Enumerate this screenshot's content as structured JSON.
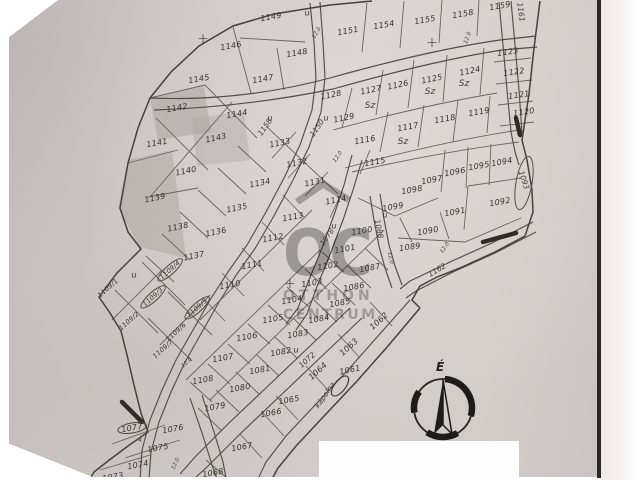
{
  "map": {
    "paper_color": "#d6d0ce",
    "ink_color": "#4c463f",
    "watermark": {
      "letters": "OC",
      "line1": "OTTHON",
      "line2": "CENTRUM"
    },
    "compass": {
      "label": "É"
    },
    "marks": {
      "u_text": "u",
      "sz_text": "Sz",
      "cross_text": "+",
      "sub_mark": "4"
    },
    "parcels": [
      {
        "id": "1149",
        "x": 271,
        "y": 17,
        "r": -10
      },
      {
        "id": "1146",
        "x": 231,
        "y": 46,
        "r": -10
      },
      {
        "id": "1148",
        "x": 297,
        "y": 53,
        "r": -10
      },
      {
        "id": "1151",
        "x": 348,
        "y": 31,
        "r": -10
      },
      {
        "id": "1154",
        "x": 384,
        "y": 25,
        "r": -10
      },
      {
        "id": "1155",
        "x": 425,
        "y": 20,
        "r": -10
      },
      {
        "id": "1158",
        "x": 463,
        "y": 14,
        "r": -10
      },
      {
        "id": "1159",
        "x": 500,
        "y": 6,
        "r": -10
      },
      {
        "id": "1145",
        "x": 199,
        "y": 79,
        "r": -10
      },
      {
        "id": "1147",
        "x": 263,
        "y": 79,
        "r": -10
      },
      {
        "id": "1142",
        "x": 177,
        "y": 108,
        "r": -10
      },
      {
        "id": "1144",
        "x": 237,
        "y": 114,
        "r": -10
      },
      {
        "id": "1143",
        "x": 216,
        "y": 138,
        "r": -12
      },
      {
        "id": "1141",
        "x": 157,
        "y": 143,
        "r": -10
      },
      {
        "id": "1140",
        "x": 186,
        "y": 171,
        "r": -12
      },
      {
        "id": "1139",
        "x": 155,
        "y": 198,
        "r": -12
      },
      {
        "id": "1133",
        "x": 280,
        "y": 143,
        "r": -12
      },
      {
        "id": "1132",
        "x": 297,
        "y": 163,
        "r": -12
      },
      {
        "id": "1131",
        "x": 315,
        "y": 182,
        "r": -12
      },
      {
        "id": "1134",
        "x": 260,
        "y": 183,
        "r": -12
      },
      {
        "id": "1135",
        "x": 237,
        "y": 208,
        "r": -12
      },
      {
        "id": "1136",
        "x": 216,
        "y": 232,
        "r": -12
      },
      {
        "id": "1138",
        "x": 178,
        "y": 227,
        "r": -12
      },
      {
        "id": "1137",
        "x": 194,
        "y": 256,
        "r": -12
      },
      {
        "id": "1128",
        "x": 331,
        "y": 95,
        "r": -12
      },
      {
        "id": "1129",
        "x": 344,
        "y": 118,
        "r": -12
      },
      {
        "id": "1127",
        "x": 371,
        "y": 90,
        "r": -12
      },
      {
        "id": "1126",
        "x": 398,
        "y": 85,
        "r": -12
      },
      {
        "id": "1125",
        "x": 432,
        "y": 79,
        "r": -12
      },
      {
        "id": "1124",
        "x": 470,
        "y": 71,
        "r": -12
      },
      {
        "id": "1123",
        "x": 508,
        "y": 52,
        "r": -8
      },
      {
        "id": "1122",
        "x": 514,
        "y": 72,
        "r": -8
      },
      {
        "id": "1121",
        "x": 519,
        "y": 95,
        "r": -8
      },
      {
        "id": "1120",
        "x": 524,
        "y": 112,
        "r": -8
      },
      {
        "id": "1119",
        "x": 479,
        "y": 112,
        "r": -10
      },
      {
        "id": "1118",
        "x": 445,
        "y": 119,
        "r": -10
      },
      {
        "id": "1117",
        "x": 408,
        "y": 127,
        "r": -10
      },
      {
        "id": "1116",
        "x": 365,
        "y": 140,
        "r": -10
      },
      {
        "id": "1115",
        "x": 375,
        "y": 162,
        "r": -10
      },
      {
        "id": "1114",
        "x": 336,
        "y": 200,
        "r": -12
      },
      {
        "id": "1113",
        "x": 293,
        "y": 217,
        "r": -10
      },
      {
        "id": "1112",
        "x": 273,
        "y": 238,
        "r": -10
      },
      {
        "id": "1111",
        "x": 252,
        "y": 265,
        "r": -10
      },
      {
        "id": "1110",
        "x": 230,
        "y": 285,
        "r": -10
      },
      {
        "id": "1096",
        "x": 455,
        "y": 172,
        "r": -10
      },
      {
        "id": "1095",
        "x": 479,
        "y": 166,
        "r": -10
      },
      {
        "id": "1094",
        "x": 502,
        "y": 162,
        "r": -10
      },
      {
        "id": "1097",
        "x": 432,
        "y": 180,
        "r": -10
      },
      {
        "id": "1098",
        "x": 412,
        "y": 190,
        "r": -10
      },
      {
        "id": "1099",
        "x": 393,
        "y": 207,
        "r": -10
      },
      {
        "id": "1092",
        "x": 500,
        "y": 202,
        "r": -10
      },
      {
        "id": "1091",
        "x": 455,
        "y": 212,
        "r": -10
      },
      {
        "id": "1090",
        "x": 428,
        "y": 231,
        "r": -10
      },
      {
        "id": "1089",
        "x": 410,
        "y": 247,
        "r": -8
      },
      {
        "id": "1100",
        "x": 362,
        "y": 231,
        "r": -10
      },
      {
        "id": "1101",
        "x": 345,
        "y": 249,
        "r": -10
      },
      {
        "id": "1102",
        "x": 328,
        "y": 266,
        "r": -10
      },
      {
        "id": "1103",
        "x": 312,
        "y": 283,
        "r": -10
      },
      {
        "id": "1104",
        "x": 292,
        "y": 300,
        "r": -10
      },
      {
        "id": "1105",
        "x": 273,
        "y": 319,
        "r": -10
      },
      {
        "id": "1106",
        "x": 247,
        "y": 337,
        "r": -10
      },
      {
        "id": "1107",
        "x": 223,
        "y": 358,
        "r": -10
      },
      {
        "id": "1108",
        "x": 203,
        "y": 380,
        "r": -10
      },
      {
        "id": "1087",
        "x": 370,
        "y": 268,
        "r": -10
      },
      {
        "id": "1086",
        "x": 354,
        "y": 287,
        "r": -10
      },
      {
        "id": "1085",
        "x": 340,
        "y": 303,
        "r": -10
      },
      {
        "id": "1084",
        "x": 319,
        "y": 319,
        "r": -10
      },
      {
        "id": "1083",
        "x": 298,
        "y": 334,
        "r": -10
      },
      {
        "id": "1082",
        "x": 281,
        "y": 352,
        "r": -10
      },
      {
        "id": "1081",
        "x": 260,
        "y": 370,
        "r": -10
      },
      {
        "id": "1080",
        "x": 240,
        "y": 388,
        "r": -10
      },
      {
        "id": "1079",
        "x": 215,
        "y": 407,
        "r": -10
      },
      {
        "id": "1077",
        "x": 132,
        "y": 428,
        "r": -10,
        "circled": true
      },
      {
        "id": "1076",
        "x": 173,
        "y": 429,
        "r": -10
      },
      {
        "id": "1075",
        "x": 158,
        "y": 448,
        "r": -10
      },
      {
        "id": "1074",
        "x": 138,
        "y": 465,
        "r": -10
      },
      {
        "id": "1073",
        "x": 113,
        "y": 477,
        "r": -10
      },
      {
        "id": "1068",
        "x": 213,
        "y": 473,
        "r": -10
      },
      {
        "id": "1067",
        "x": 242,
        "y": 447,
        "r": -10
      },
      {
        "id": "1066",
        "x": 271,
        "y": 413,
        "r": -10
      },
      {
        "id": "1065",
        "x": 289,
        "y": 400,
        "r": -10
      },
      {
        "id": "1061",
        "x": 350,
        "y": 370,
        "r": -12
      },
      {
        "id": "1062",
        "x": 379,
        "y": 321,
        "r": -42
      },
      {
        "id": "1063",
        "x": 349,
        "y": 347,
        "r": -42
      },
      {
        "id": "1064",
        "x": 318,
        "y": 371,
        "r": -42
      },
      {
        "id": "1109/1",
        "x": 108,
        "y": 288,
        "r": -42,
        "small": true
      },
      {
        "id": "1109/2",
        "x": 129,
        "y": 321,
        "r": -42,
        "small": true
      },
      {
        "id": "1109/3",
        "x": 153,
        "y": 297,
        "r": -42,
        "small": true,
        "circled": true
      },
      {
        "id": "1109/4",
        "x": 170,
        "y": 270,
        "r": -42,
        "small": true,
        "circled": true
      },
      {
        "id": "1109/5",
        "x": 197,
        "y": 308,
        "r": -42,
        "small": true,
        "circled": true
      },
      {
        "id": "1109/6",
        "x": 176,
        "y": 332,
        "r": -42,
        "small": true
      },
      {
        "id": "1109/7",
        "x": 163,
        "y": 349,
        "r": -42,
        "small": true
      }
    ],
    "streets": [
      {
        "id": "1150",
        "x": 317,
        "y": 128,
        "r": -55
      },
      {
        "id": "1158",
        "x": 265,
        "y": 127,
        "r": -55
      },
      {
        "id": "1161",
        "x": 521,
        "y": 12,
        "r": 82
      },
      {
        "id": "1088",
        "x": 379,
        "y": 229,
        "r": 78
      },
      {
        "id": "1078",
        "x": 327,
        "y": 237,
        "r": -55
      },
      {
        "id": "1072",
        "x": 307,
        "y": 360,
        "r": -42
      },
      {
        "id": "1162",
        "x": 437,
        "y": 270,
        "r": -30
      },
      {
        "id": "kápolna",
        "x": 325,
        "y": 395,
        "r": -55
      },
      {
        "id": "1093",
        "x": 524,
        "y": 180,
        "r": 72
      }
    ],
    "dimensions": [
      {
        "text": "12.0",
        "x": 338,
        "y": 157,
        "r": -55
      },
      {
        "text": "12.0",
        "x": 390,
        "y": 258,
        "r": 78
      },
      {
        "text": "12.0",
        "x": 187,
        "y": 363,
        "r": -42
      },
      {
        "text": "12.0",
        "x": 176,
        "y": 464,
        "r": -65
      },
      {
        "text": "12.0",
        "x": 445,
        "y": 248,
        "r": -55
      },
      {
        "text": "12.0",
        "x": 468,
        "y": 38,
        "r": -70
      },
      {
        "text": "12.0",
        "x": 317,
        "y": 33,
        "r": -60
      }
    ],
    "u_marks": [
      {
        "x": 307,
        "y": 13
      },
      {
        "x": 270,
        "y": 118
      },
      {
        "x": 326,
        "y": 118
      },
      {
        "x": 334,
        "y": 226
      },
      {
        "x": 385,
        "y": 215
      },
      {
        "x": 296,
        "y": 350
      },
      {
        "x": 134,
        "y": 275
      }
    ],
    "sz_marks": [
      {
        "x": 430,
        "y": 92
      },
      {
        "x": 464,
        "y": 84
      },
      {
        "x": 403,
        "y": 142
      },
      {
        "x": 370,
        "y": 106
      }
    ],
    "crosses": [
      {
        "x": 203,
        "y": 39
      },
      {
        "x": 432,
        "y": 43
      },
      {
        "x": 290,
        "y": 284
      }
    ],
    "sub_marks": [
      {
        "x": 140,
        "y": 441
      }
    ]
  }
}
